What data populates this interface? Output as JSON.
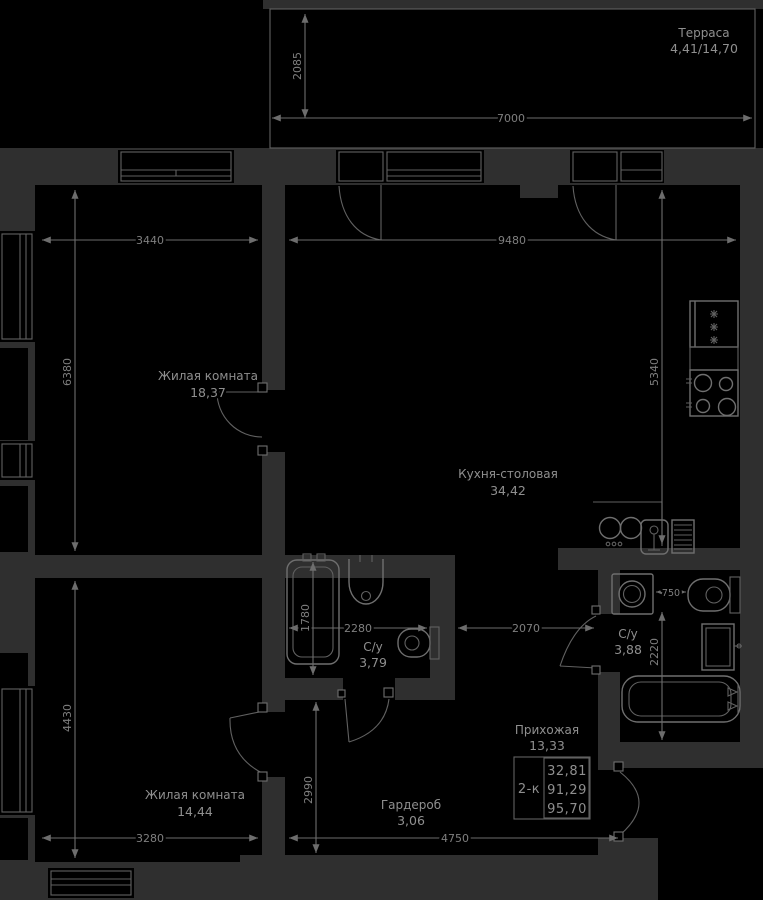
{
  "meta": {
    "kind": "apartment-floor-plan"
  },
  "colors": {
    "background": "#000000",
    "wall": "#2f2f2f",
    "line": "#6f6f6f",
    "text": "#8f8f8f"
  },
  "terrace": {
    "name": "Терраса",
    "area": "4,41/14,70"
  },
  "rooms": {
    "living1": {
      "name": "Жилая комната",
      "area": "18,37"
    },
    "kitchen": {
      "name": "Кухня-столовая",
      "area": "34,42"
    },
    "bath1": {
      "name": "С/у",
      "area": "3,79"
    },
    "bath2": {
      "name": "С/у",
      "area": "3,88"
    },
    "hall": {
      "name": "Прихожая",
      "area": "13,33"
    },
    "wardrobe": {
      "name": "Гардероб",
      "area": "3,06"
    },
    "living2": {
      "name": "Жилая комната",
      "area": "14,44"
    }
  },
  "dimensions": {
    "terrace_width": "7000",
    "terrace_depth": "2085",
    "living1_width": "3440",
    "living1_depth": "6380",
    "kitchen_width": "9480",
    "kitchen_depth": "5340",
    "bath1_width": "2280",
    "bath1_tub_length": "1780",
    "hall_width": "2070",
    "bath2_gap": "750",
    "bath2_depth": "2220",
    "living2_depth": "4430",
    "living2_width": "3280",
    "wardrobe_depth": "2990",
    "hall_bottom_width": "4750"
  },
  "info_box": {
    "plan_type": "2-к",
    "living_area": "32,81",
    "area": "91,29",
    "total_area": "95,70"
  }
}
